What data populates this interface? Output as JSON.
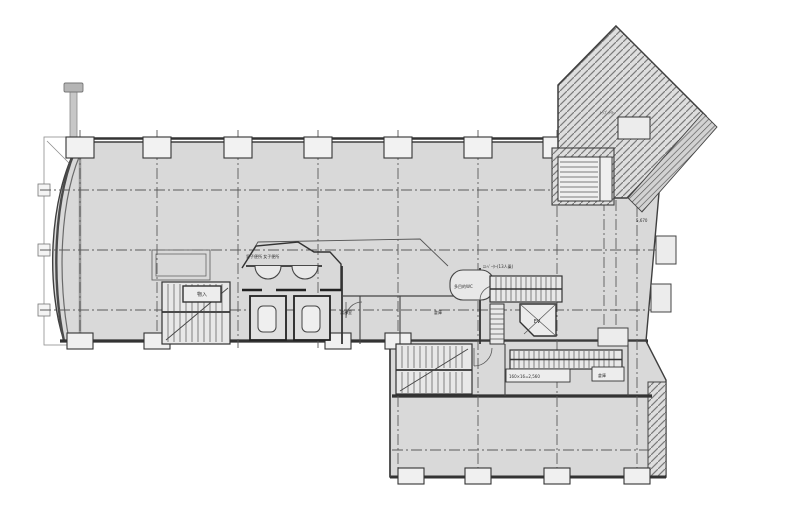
{
  "drawing": {
    "type": "architectural-floor-plan",
    "background_color": "#ffffff",
    "floor_fill_color": "#d9d9d9",
    "wall_line_color": "#3a3a3a",
    "hatch_line_color": "#7a7a7a",
    "grid_line_color": "#5a5a5a"
  },
  "labels": {
    "toilet_header": "男子便所 女子便所",
    "storage_small": "物入",
    "kitchenette": "湯沸室",
    "room_center": "倉庫",
    "accessible_wc": "多目的WC",
    "elevator_note": "ｴﾚﾍﾞｰﾀｰ(13人乗)",
    "elevator": "EV",
    "rooflight": "ﾄｯﾌﾟﾗｲﾄ",
    "stair_note": "160×16=2,560",
    "storage_right": "倉庫",
    "dim_right": "5,670"
  }
}
